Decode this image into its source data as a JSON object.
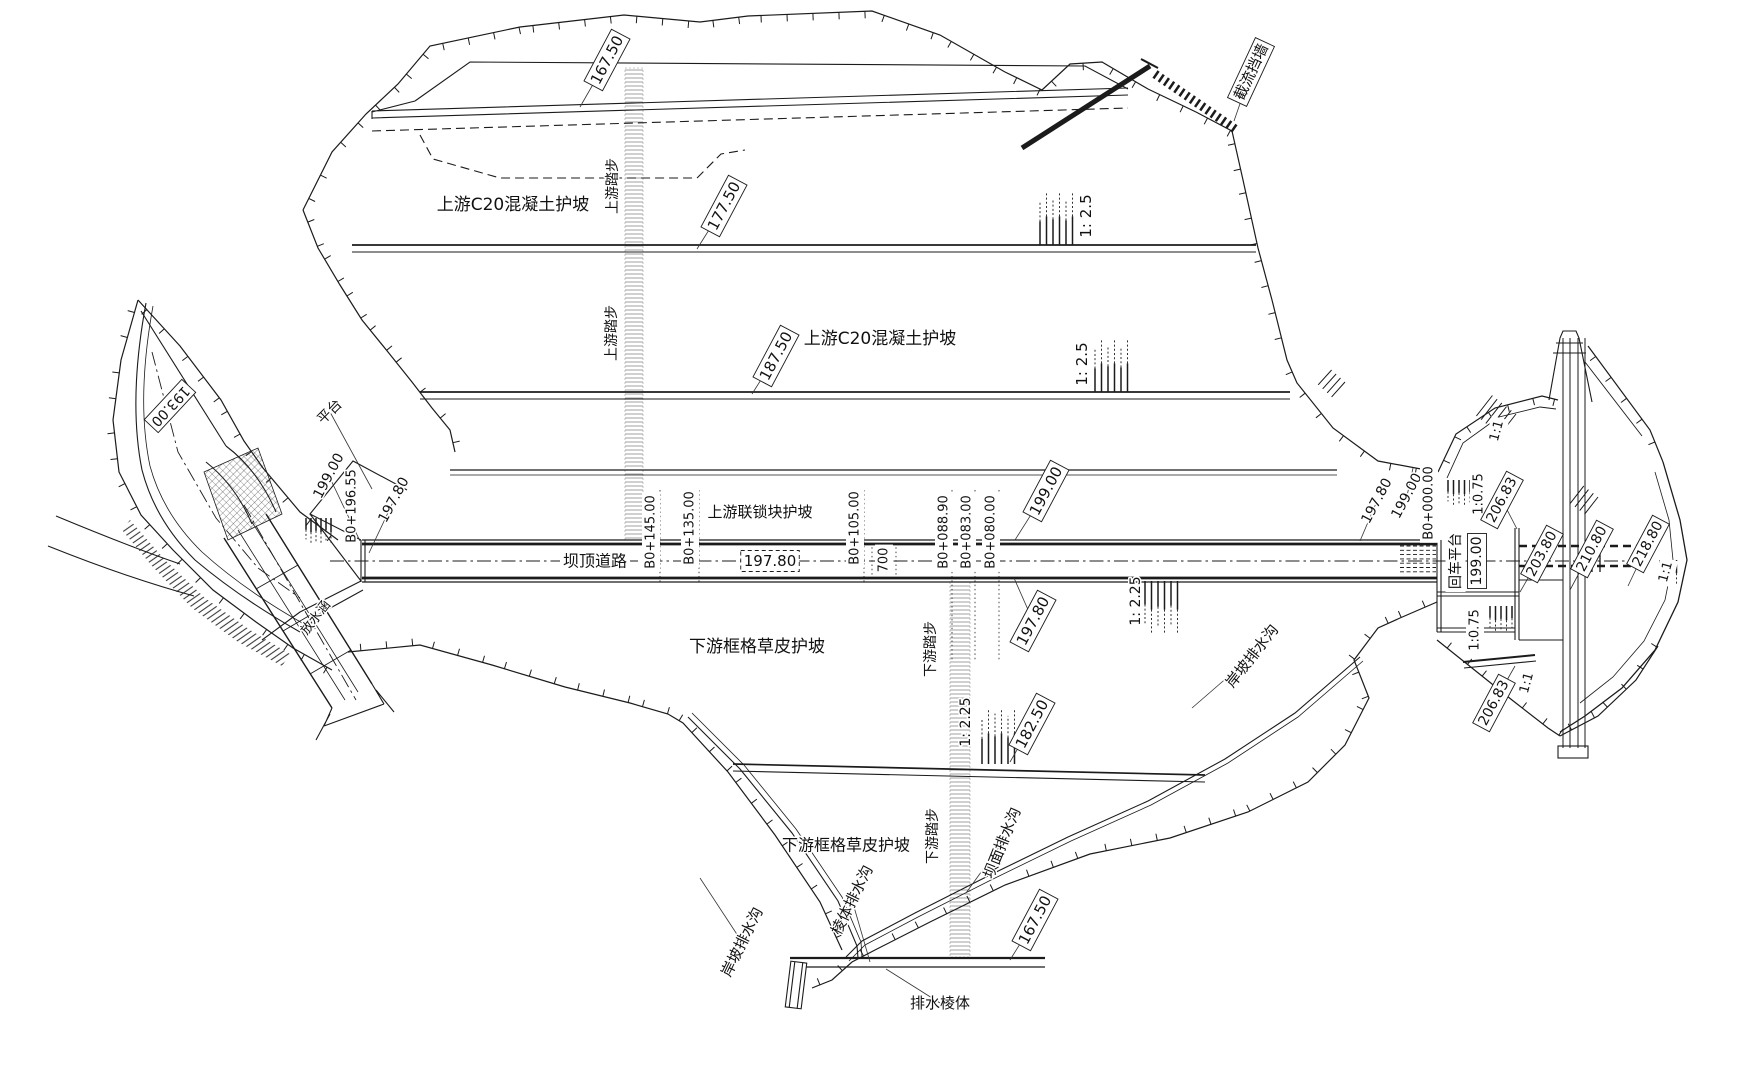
{
  "colors": {
    "ink": "#1b1b1b",
    "paper": "#ffffff"
  },
  "drawing": {
    "type": "dam-plan-engineering-drawing",
    "labels": [
      {
        "name": "elev-167-50-upstream",
        "text": "167.50",
        "x": 607,
        "y": 60,
        "rot": -62,
        "fs": 15,
        "style": "box-leader",
        "tail": [
          580,
          107
        ]
      },
      {
        "name": "note-upstream-c20-slope-a",
        "text": "上游C20混凝土护坡",
        "x": 513,
        "y": 205,
        "rot": 0,
        "fs": 17,
        "style": "plain"
      },
      {
        "name": "note-upstream-steps-a",
        "text": "上游踏步",
        "x": 613,
        "y": 186,
        "rot": -90,
        "fs": 14,
        "style": "plain"
      },
      {
        "name": "elev-177-50",
        "text": "177.50",
        "x": 724,
        "y": 206,
        "rot": -62,
        "fs": 15,
        "style": "box-leader",
        "tail": [
          697,
          249
        ]
      },
      {
        "name": "note-upstream-steps-b",
        "text": "上游踏步",
        "x": 612,
        "y": 333,
        "rot": -90,
        "fs": 14,
        "style": "plain"
      },
      {
        "name": "elev-187-50",
        "text": "187.50",
        "x": 776,
        "y": 356,
        "rot": -62,
        "fs": 15,
        "style": "box-leader",
        "tail": [
          752,
          394
        ]
      },
      {
        "name": "note-upstream-c20-slope-b",
        "text": "上游C20混凝土护坡",
        "x": 880,
        "y": 339,
        "rot": 0,
        "fs": 17,
        "style": "plain"
      },
      {
        "name": "slope-1-2-5-a",
        "text": "1: 2.5",
        "x": 1086,
        "y": 216,
        "rot": -90,
        "fs": 15,
        "style": "plain"
      },
      {
        "name": "slope-1-2-5-b",
        "text": "1: 2.5",
        "x": 1082,
        "y": 364,
        "rot": -90,
        "fs": 15,
        "style": "plain"
      },
      {
        "name": "note-closure-wall",
        "text": "截流挡墙",
        "x": 1251,
        "y": 72,
        "rot": -65,
        "fs": 15,
        "style": "box-leader",
        "tail": [
          1234,
          121
        ]
      },
      {
        "name": "note-platform",
        "text": "平台",
        "x": 330,
        "y": 412,
        "rot": -45,
        "fs": 14,
        "style": "leader",
        "tail": [
          372,
          489
        ]
      },
      {
        "name": "elev-193-00",
        "text": "193.00",
        "x": 170,
        "y": 406,
        "rot": 133,
        "fs": 14,
        "style": "box"
      },
      {
        "name": "elev-199-00-left",
        "text": "199.00",
        "x": 329,
        "y": 476,
        "rot": -62,
        "fs": 14,
        "style": "leader",
        "tail": [
          360,
          541
        ]
      },
      {
        "name": "station-b0-196-55",
        "text": "B0+196.55",
        "x": 352,
        "y": 506,
        "rot": -90,
        "fs": 13,
        "style": "plain"
      },
      {
        "name": "elev-197-80-left",
        "text": "197.80",
        "x": 394,
        "y": 500,
        "rot": -62,
        "fs": 14,
        "style": "leader",
        "tail": [
          369,
          553
        ]
      },
      {
        "name": "note-crest-road",
        "text": "坝顶道路",
        "x": 595,
        "y": 561,
        "rot": 0,
        "fs": 16,
        "style": "plain-bg"
      },
      {
        "name": "elev-197-80-crest",
        "text": "197.80",
        "x": 770,
        "y": 561,
        "rot": 0,
        "fs": 15,
        "style": "dashed-box"
      },
      {
        "name": "station-b0-145-00",
        "text": "B0+145.00",
        "x": 651,
        "y": 532,
        "rot": -90,
        "fs": 13,
        "style": "plain-bg"
      },
      {
        "name": "station-b0-135-00",
        "text": "B0+135.00",
        "x": 690,
        "y": 528,
        "rot": -90,
        "fs": 13,
        "style": "plain-bg"
      },
      {
        "name": "station-b0-105-00",
        "text": "B0+105.00",
        "x": 855,
        "y": 528,
        "rot": -90,
        "fs": 13,
        "style": "plain-bg"
      },
      {
        "name": "dim-700",
        "text": "700",
        "x": 884,
        "y": 560,
        "rot": -90,
        "fs": 13,
        "style": "plain-bg"
      },
      {
        "name": "station-b0-088-90",
        "text": "B0+088.90",
        "x": 944,
        "y": 532,
        "rot": -90,
        "fs": 13,
        "style": "plain-bg"
      },
      {
        "name": "station-b0-083-00",
        "text": "B0+083.00",
        "x": 967,
        "y": 532,
        "rot": -90,
        "fs": 13,
        "style": "plain-bg"
      },
      {
        "name": "station-b0-080-00",
        "text": "B0+080.00",
        "x": 991,
        "y": 532,
        "rot": -90,
        "fs": 13,
        "style": "plain-bg"
      },
      {
        "name": "note-upstream-interlock-slope",
        "text": "上游联锁块护坡",
        "x": 760,
        "y": 512,
        "rot": 0,
        "fs": 15,
        "style": "plain-bg"
      },
      {
        "name": "elev-199-00-crest",
        "text": "199.00",
        "x": 1046,
        "y": 491,
        "rot": -62,
        "fs": 15,
        "style": "box-leader",
        "tail": [
          1015,
          540
        ]
      },
      {
        "name": "elev-197-80-right",
        "text": "197.80",
        "x": 1377,
        "y": 501,
        "rot": -62,
        "fs": 14,
        "style": "leader",
        "tail": [
          1360,
          541
        ]
      },
      {
        "name": "elev-199-00-right",
        "text": "199.00",
        "x": 1407,
        "y": 496,
        "rot": -62,
        "fs": 14,
        "style": "leader",
        "tail": [
          1413,
          468
        ]
      },
      {
        "name": "station-b0-000-00",
        "text": "B0+000.00",
        "x": 1429,
        "y": 503,
        "rot": -90,
        "fs": 13,
        "style": "plain-bg"
      },
      {
        "name": "note-turnaround-platform",
        "text": "回车平台",
        "x": 1456,
        "y": 561,
        "rot": -90,
        "fs": 14,
        "style": "plain-bg"
      },
      {
        "name": "elev-199-00-platform",
        "text": "199.00",
        "x": 1477,
        "y": 561,
        "rot": -90,
        "fs": 14,
        "style": "box"
      },
      {
        "name": "slope-1-0-75-a",
        "text": "1:0.75",
        "x": 1479,
        "y": 494,
        "rot": -90,
        "fs": 13,
        "style": "plain-bg"
      },
      {
        "name": "elev-206-83-top",
        "text": "206.83",
        "x": 1502,
        "y": 500,
        "rot": -62,
        "fs": 14,
        "style": "box-leader",
        "tail": [
          1517,
          529
        ]
      },
      {
        "name": "slope-1-1-a",
        "text": "1:1",
        "x": 1497,
        "y": 431,
        "rot": -75,
        "fs": 13,
        "style": "plain-bg"
      },
      {
        "name": "elev-203-80",
        "text": "203.80",
        "x": 1542,
        "y": 554,
        "rot": -62,
        "fs": 14,
        "style": "box-leader",
        "tail": [
          1520,
          592
        ]
      },
      {
        "name": "elev-210-80",
        "text": "210.80",
        "x": 1592,
        "y": 549,
        "rot": -62,
        "fs": 14,
        "style": "box-leader",
        "tail": [
          1570,
          590
        ]
      },
      {
        "name": "elev-218-80",
        "text": "218.80",
        "x": 1648,
        "y": 544,
        "rot": -62,
        "fs": 14,
        "style": "box-leader",
        "tail": [
          1628,
          586
        ]
      },
      {
        "name": "slope-1-1-b",
        "text": "1:1",
        "x": 1666,
        "y": 572,
        "rot": -75,
        "fs": 13,
        "style": "plain-bg"
      },
      {
        "name": "slope-1-0-75-b",
        "text": "1:0.75",
        "x": 1475,
        "y": 630,
        "rot": -90,
        "fs": 13,
        "style": "plain-bg"
      },
      {
        "name": "slope-1-1-c",
        "text": "1:1",
        "x": 1527,
        "y": 683,
        "rot": -75,
        "fs": 13,
        "style": "plain-bg"
      },
      {
        "name": "elev-206-83-bottom",
        "text": "206.83",
        "x": 1494,
        "y": 703,
        "rot": -62,
        "fs": 14,
        "style": "box-leader",
        "tail": [
          1515,
          666
        ]
      },
      {
        "name": "note-bank-drain-right",
        "text": "岸坡排水沟",
        "x": 1252,
        "y": 656,
        "rot": -52,
        "fs": 15,
        "style": "leader",
        "tail": [
          1192,
          708
        ]
      },
      {
        "name": "slope-1-2-25-a",
        "text": "1: 2.25",
        "x": 1136,
        "y": 601,
        "rot": -90,
        "fs": 14,
        "style": "plain"
      },
      {
        "name": "note-downstream-grid-slope-a",
        "text": "下游框格草皮护坡",
        "x": 757,
        "y": 647,
        "rot": 0,
        "fs": 17,
        "style": "plain"
      },
      {
        "name": "elev-197-80-downstream",
        "text": "197.80",
        "x": 1033,
        "y": 621,
        "rot": -62,
        "fs": 15,
        "style": "box-leader",
        "tail": [
          1014,
          578
        ]
      },
      {
        "name": "elev-182-50",
        "text": "182.50",
        "x": 1032,
        "y": 724,
        "rot": -62,
        "fs": 15,
        "style": "box-leader",
        "tail": [
          1010,
          762
        ]
      },
      {
        "name": "slope-1-2-25-b",
        "text": "1: 2.25",
        "x": 966,
        "y": 722,
        "rot": -90,
        "fs": 14,
        "style": "plain"
      },
      {
        "name": "note-downstream-steps-a",
        "text": "下游踏步",
        "x": 931,
        "y": 649,
        "rot": -90,
        "fs": 14,
        "style": "plain"
      },
      {
        "name": "note-downstream-grid-slope-b",
        "text": "下游框格草皮护坡",
        "x": 846,
        "y": 845,
        "rot": 0,
        "fs": 16,
        "style": "plain"
      },
      {
        "name": "note-downstream-steps-b",
        "text": "下游踏步",
        "x": 933,
        "y": 836,
        "rot": -90,
        "fs": 14,
        "style": "plain"
      },
      {
        "name": "note-dam-face-drain",
        "text": "坝面排水沟",
        "x": 1002,
        "y": 843,
        "rot": -68,
        "fs": 15,
        "style": "leader",
        "tail": [
          966,
          893
        ]
      },
      {
        "name": "note-prism-drain",
        "text": "棱体排水沟",
        "x": 852,
        "y": 900,
        "rot": -64,
        "fs": 15,
        "style": "leader",
        "tail": [
          870,
          962
        ]
      },
      {
        "name": "note-bank-drain-left",
        "text": "岸坡排水沟",
        "x": 742,
        "y": 942,
        "rot": -64,
        "fs": 15,
        "style": "leader",
        "tail": [
          700,
          878
        ]
      },
      {
        "name": "elev-167-50-downstream",
        "text": "167.50",
        "x": 1035,
        "y": 920,
        "rot": -62,
        "fs": 15,
        "style": "box-leader",
        "tail": [
          1010,
          960
        ]
      },
      {
        "name": "note-drain-prism",
        "text": "排水棱体",
        "x": 940,
        "y": 1003,
        "rot": 0,
        "fs": 15,
        "style": "leader",
        "tail": [
          886,
          969
        ]
      },
      {
        "name": "note-outlet-culvert",
        "text": "放水涵",
        "x": 316,
        "y": 618,
        "rot": -52,
        "fs": 13,
        "style": "plain"
      }
    ]
  }
}
